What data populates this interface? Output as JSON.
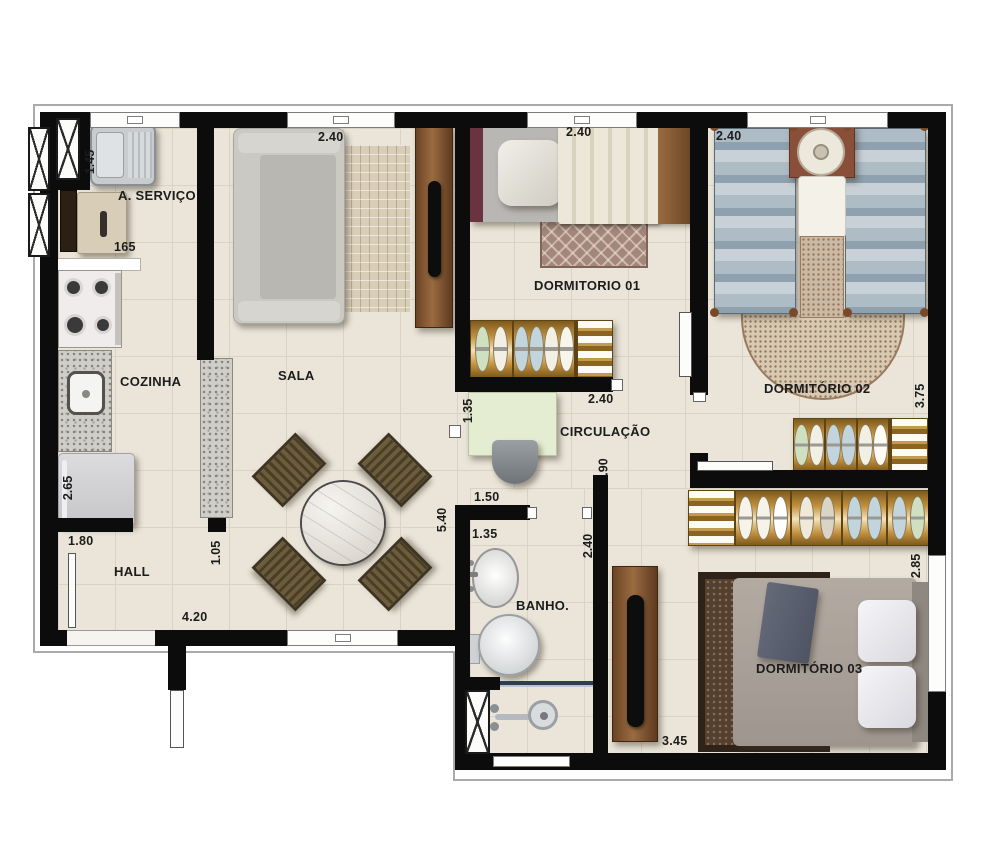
{
  "labels": {
    "servico": "A. SERVIÇO",
    "cozinha": "COZINHA",
    "sala": "SALA",
    "hall": "HALL",
    "dorm1": "DORMITORIO 01",
    "dorm2": "DORMITÓRIO 02",
    "dorm3": "DORMITÓRIO 03",
    "circulacao": "CIRCULAÇÃO",
    "banho": "BANHO."
  },
  "dims": {
    "sala_window": "2.40",
    "dorm1_width_top": "2.40",
    "dorm2_width": "2.40",
    "servico_depth": "1.45",
    "servico_width": "165",
    "cozinha_length": "2.65",
    "hall_opening": "1.80",
    "counter_length": "1.05",
    "hall_width": "4.20",
    "sala_length": "5.40",
    "banho_door": "1.50",
    "banho_width": "1.35",
    "desk_nook": "1.35",
    "dorm1_width_bottom": "2.40",
    "circ_opening": ".90",
    "banho_wall": "2.40",
    "dorm2_length": "3.75",
    "dorm3_length": "2.85",
    "dorm3_width": "3.45"
  },
  "colors": {
    "wall": "#0c0c0c",
    "floor": "#eae5d8",
    "wardrobe_wood": "#c2913e",
    "furniture_wood": "#8a6a42",
    "quilt_blue": "#aebcc6",
    "label_text": "#1c1c1c"
  }
}
